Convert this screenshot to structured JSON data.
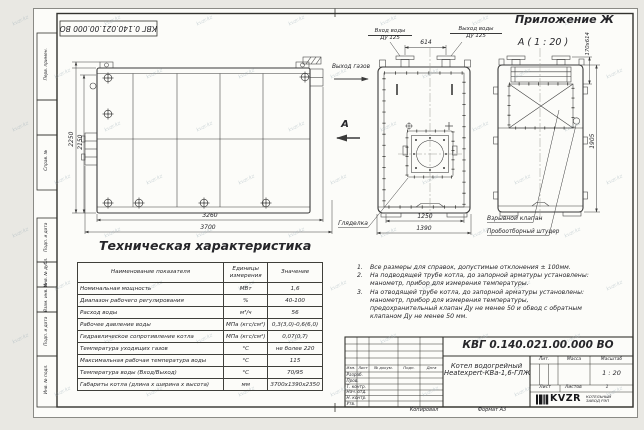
{
  "sheet": {
    "code": "КВГ 0.140.021.00.000 ВО",
    "appendix": "Приложение Ж",
    "view_title": "А ( 1 : 20 )",
    "copied": "Копировал",
    "format": "Формат А3"
  },
  "margin": {
    "cells": [
      "Перв. примен.",
      "Справ. №",
      "Подп. и дата",
      "Инв. № дубл.",
      "Взам. инв. №",
      "Подп. и дата",
      "Инв. № подл."
    ]
  },
  "annotations": {
    "water_inlet_l1": "Вход воды",
    "water_inlet_l2": "Ду 125",
    "water_outlet_l1": "Выход воды",
    "water_outlet_l2": "Ду 125",
    "gas_outlet": "Выход газов",
    "section_mark": "А",
    "sight_glass": "Гляделка",
    "explosion_valve": "Взрывной клапан",
    "sampling_fitting": "Пробоотборный штуцер"
  },
  "dimensions": {
    "height_total": "2250",
    "height_body": "2150",
    "length_body": "3260",
    "length_total": "3700",
    "flange_spacing": "614",
    "width_body": "1250",
    "width_total": "1390",
    "outlet_opening": "170х614",
    "rear_height": "1905"
  },
  "tech_table": {
    "title": "Техническая характеристика",
    "headers": [
      "Наименование показателя",
      "Единицы измерения",
      "Значение"
    ],
    "rows": [
      [
        "Номинальная мощность",
        "МВт",
        "1,6"
      ],
      [
        "Диапазон рабочего регулирования",
        "%",
        "40-100"
      ],
      [
        "Расход воды",
        "м³/ч",
        "56"
      ],
      [
        "Рабочее давление воды",
        "МПа (кгс/см²)",
        "0,3(3,0)-0,6(6,0)"
      ],
      [
        "Гидравлическое сопротивление котла",
        "МПа (кгс/см²)",
        "0,07(0,7)"
      ],
      [
        "Температура уходящих газов",
        "°С",
        "не более 220"
      ],
      [
        "Максимальная рабочая температура воды",
        "°С",
        "115"
      ],
      [
        "Температура воды (Вход/Выход)",
        "°С",
        "70/95"
      ],
      [
        "Габариты котла (длина х ширина х высота)",
        "мм",
        "3700х1390х2350"
      ]
    ]
  },
  "notes": {
    "items": [
      {
        "num": "1.",
        "text": "Все размеры для справок, допустимые отклонения ± 100мм."
      },
      {
        "num": "2.",
        "text": "На подводящей трубе котла, до запорной арматуры установлены: манометр, прибор для измерения температуры."
      },
      {
        "num": "3.",
        "text": "На отводящей трубе котла, до запорной арматуры установлены: манометр, прибор для измерения температуры, предохранительный клапан Ду не менее 50 и обвод с обратным клапаном Ду не менее 50 мм."
      }
    ]
  },
  "title_block": {
    "doc_number": "КВГ 0.140.021.00.000 ВО",
    "name_line1": "Котел водогрейный",
    "name_line2": "Heatexpert-КВа-1,6-ГЛЖ",
    "cols": {
      "izm": "Изм.",
      "list": "Лист",
      "doc": "№ докум.",
      "podp": "Подп.",
      "date": "Дата"
    },
    "rows": [
      "Разраб.",
      "Пров.",
      "Т. контр.",
      "Нач. отд.",
      "Н. контр.",
      "Утв."
    ],
    "lit": "Лит.",
    "mass": "Масса",
    "scale": "Масштаб",
    "scale_value": "1 : 20",
    "sheet": "Лист",
    "sheets": "Листов",
    "sheets_value": "1",
    "logo": "KVZR",
    "company_l1": "КОТЕЛЬНЫЙ",
    "company_l2": "ЗАВОД РЭП"
  },
  "watermark": {
    "text": "kvzr.kz"
  }
}
